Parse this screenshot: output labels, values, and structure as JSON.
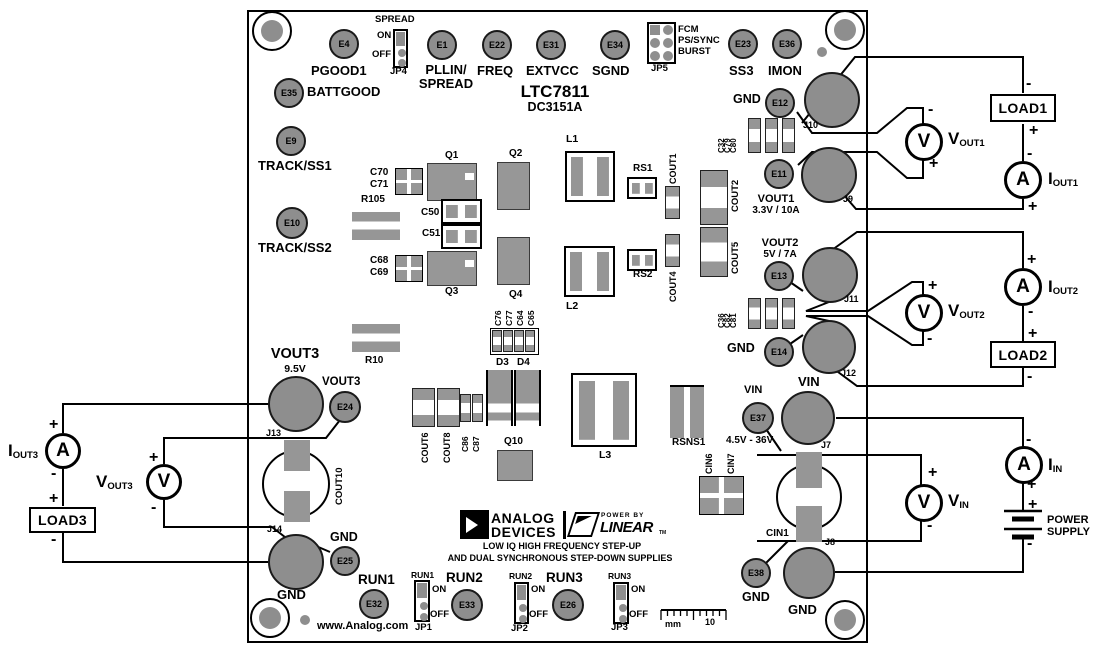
{
  "board": {
    "part": "LTC7811",
    "model": "DC3151A",
    "website": "www.Analog.com",
    "tagline1": "LOW IQ HIGH FREQUENCY STEP-UP",
    "tagline2": "AND DUAL SYNCHRONOUS STEP-DOWN SUPPLIES",
    "brand": {
      "analog": "ANALOG",
      "devices": "DEVICES",
      "power_by": "POWER BY",
      "linear": "LINEAR",
      "tm": "TM"
    }
  },
  "signs": {
    "plus": "+",
    "minus": "-"
  },
  "test_points": {
    "e4": {
      "id": "E4",
      "label": "PGOOD1"
    },
    "e35": {
      "id": "E35",
      "label": "BATTGOOD"
    },
    "e1": {
      "id": "E1",
      "label1": "PLLIN/",
      "label2": "SPREAD"
    },
    "e22": {
      "id": "E22",
      "label": "FREQ"
    },
    "e31": {
      "id": "E31",
      "label": "EXTVCC"
    },
    "e34": {
      "id": "E34",
      "label": "SGND"
    },
    "e23": {
      "id": "E23",
      "label": "SS3"
    },
    "e36": {
      "id": "E36",
      "label": "IMON"
    },
    "e9": {
      "id": "E9",
      "label": "TRACK/SS1"
    },
    "e10": {
      "id": "E10",
      "label": "TRACK/SS2"
    },
    "e12": {
      "id": "E12",
      "label": "GND"
    },
    "e11": {
      "id": "E11",
      "label": "VOUT1",
      "spec": "3.3V / 10A"
    },
    "e13": {
      "id": "E13",
      "label": "VOUT2",
      "spec": "5V / 7A"
    },
    "e14": {
      "id": "E14",
      "label": "GND"
    },
    "e37": {
      "id": "E37",
      "label": "VIN",
      "spec": "4.5V - 36V"
    },
    "e38": {
      "id": "E38",
      "label": "GND"
    },
    "e24": {
      "id": "E24",
      "label": "VOUT3"
    },
    "e25": {
      "id": "E25",
      "label": "GND"
    },
    "e32": {
      "id": "E32",
      "label": "RUN1"
    },
    "e33": {
      "id": "E33",
      "label": "RUN2"
    },
    "e26": {
      "id": "E26",
      "label": "RUN3"
    }
  },
  "jumpers": {
    "jp4": {
      "id": "JP4",
      "title": "SPREAD",
      "on": "ON",
      "off": "OFF"
    },
    "jp5": {
      "id": "JP5",
      "opt1": "FCM",
      "opt2": "PS/SYNC",
      "opt3": "BURST"
    },
    "jp1": {
      "id": "JP1",
      "title": "RUN1",
      "on": "ON",
      "off": "OFF"
    },
    "jp2": {
      "id": "JP2",
      "title": "RUN2",
      "on": "ON",
      "off": "OFF"
    },
    "jp3": {
      "id": "JP3",
      "title": "RUN3",
      "on": "ON",
      "off": "OFF"
    }
  },
  "rails": {
    "vout3_name": "VOUT3",
    "vout3_spec": "9.5V",
    "vin_big": "VIN",
    "gnd_input": "GND",
    "gnd_j14": "GND"
  },
  "components": {
    "q1": "Q1",
    "q2": "Q2",
    "q3": "Q3",
    "q4": "Q4",
    "q10": "Q10",
    "l1": "L1",
    "l2": "L2",
    "l3": "L3",
    "c70": "C70",
    "c71": "C71",
    "c50": "C50",
    "c51": "C51",
    "c68": "C68",
    "c69": "C69",
    "r105": "R105",
    "r10": "R10",
    "rs1": "RS1",
    "rs2": "RS2",
    "rsns1": "RSNS1",
    "cout1": "COUT1",
    "cout2": "COUT2",
    "cout4": "COUT4",
    "cout5": "COUT5",
    "cout6": "COUT6",
    "cout8": "COUT8",
    "cout10": "COUT10",
    "c32": "C32",
    "c79": "C79",
    "c80": "C80",
    "c36": "C36",
    "c82": "C82",
    "c81": "C81",
    "c76": "C76",
    "c77": "C77",
    "c64": "C64",
    "c65": "C65",
    "c86": "C86",
    "c87": "C87",
    "d3": "D3",
    "d4": "D4",
    "cin1": "CIN1",
    "cin6": "CIN6",
    "cin7": "CIN7",
    "j7": "J7",
    "j8": "J8",
    "j9": "J9",
    "j10": "J10",
    "j11": "J11",
    "j12": "J12",
    "j13": "J13",
    "j14": "J14"
  },
  "external": {
    "load1": "LOAD1",
    "load2": "LOAD2",
    "load3": "LOAD3",
    "power_supply": "POWER SUPPLY",
    "meters": {
      "vout1": {
        "glyph": "V",
        "main": "V",
        "sub": "OUT1"
      },
      "iout1": {
        "glyph": "A",
        "main": "I",
        "sub": "OUT1"
      },
      "vout2": {
        "glyph": "V",
        "main": "V",
        "sub": "OUT2"
      },
      "iout2": {
        "glyph": "A",
        "main": "I",
        "sub": "OUT2"
      },
      "vin": {
        "glyph": "V",
        "main": "V",
        "sub": "IN"
      },
      "iin": {
        "glyph": "A",
        "main": "I",
        "sub": "IN"
      },
      "vout3": {
        "glyph": "V",
        "main": "V",
        "sub": "OUT3"
      },
      "iout3": {
        "glyph": "A",
        "main": "I",
        "sub": "OUT3"
      }
    }
  },
  "ruler": {
    "unit": "mm",
    "mark": "10"
  }
}
